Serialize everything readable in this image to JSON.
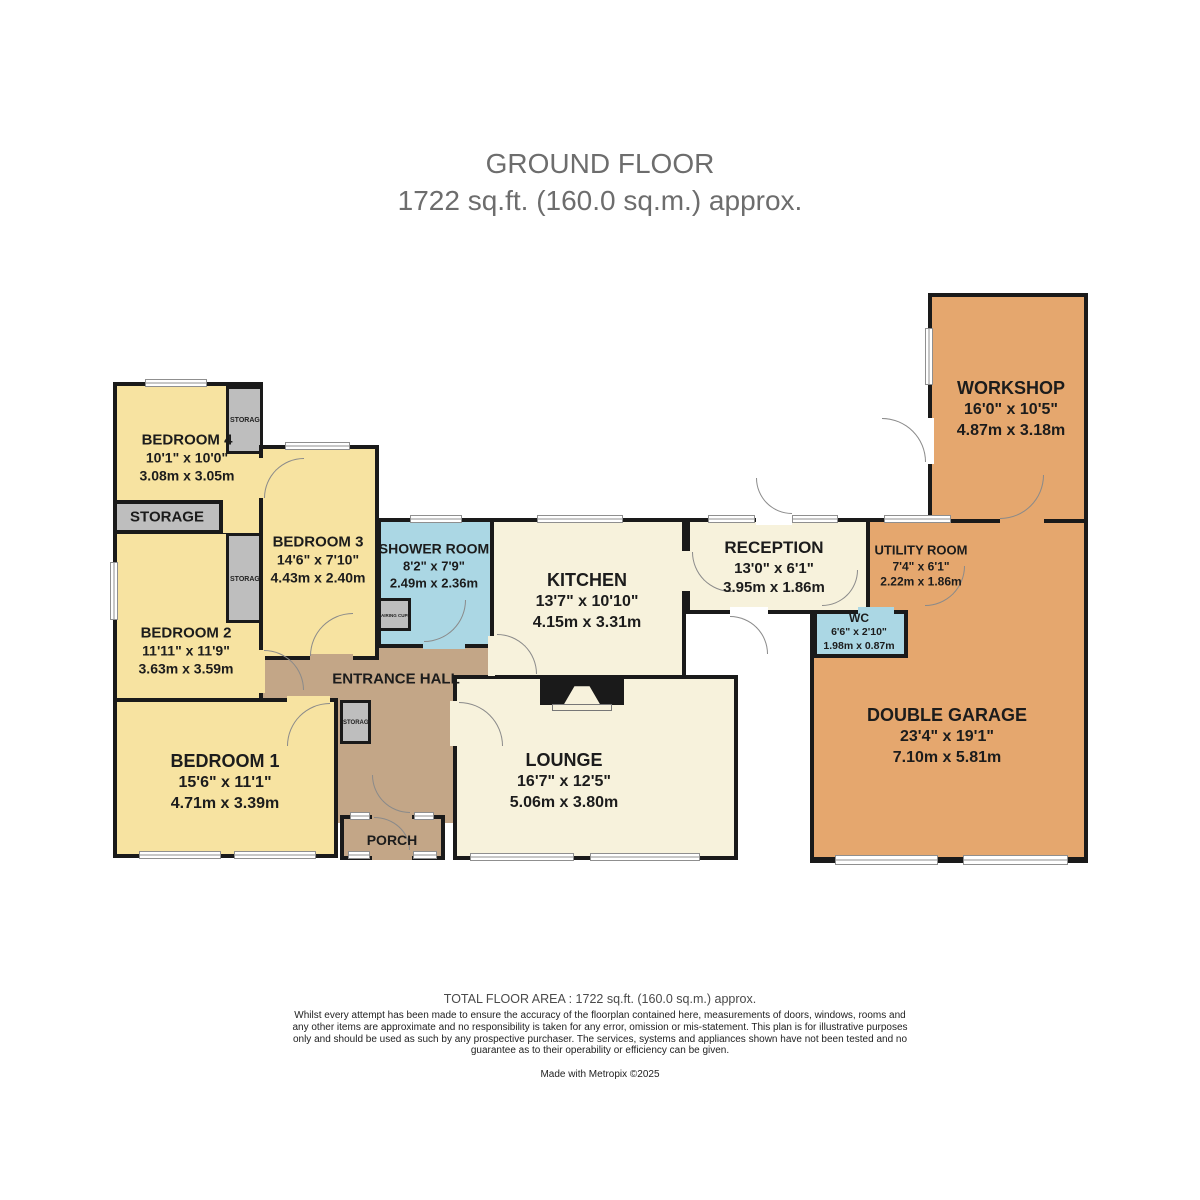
{
  "title": {
    "line1": "GROUND FLOOR",
    "line2": "1722 sq.ft. (160.0 sq.m.) approx."
  },
  "rooms": {
    "bedroom4": {
      "name": "BEDROOM 4",
      "imperial": "10'1\" x 10'0\"",
      "metric": "3.08m x 3.05m"
    },
    "bedroom3": {
      "name": "BEDROOM 3",
      "imperial": "14'6\" x 7'10\"",
      "metric": "4.43m x 2.40m"
    },
    "bedroom2": {
      "name": "BEDROOM 2",
      "imperial": "11'11\" x 11'9\"",
      "metric": "3.63m x 3.59m"
    },
    "bedroom1": {
      "name": "BEDROOM 1",
      "imperial": "15'6\" x 11'1\"",
      "metric": "4.71m x 3.39m"
    },
    "shower_room": {
      "name": "SHOWER ROOM",
      "imperial": "8'2\" x 7'9\"",
      "metric": "2.49m x 2.36m"
    },
    "kitchen": {
      "name": "KITCHEN",
      "imperial": "13'7\" x 10'10\"",
      "metric": "4.15m x 3.31m"
    },
    "lounge": {
      "name": "LOUNGE",
      "imperial": "16'7\" x 12'5\"",
      "metric": "5.06m x 3.80m"
    },
    "reception": {
      "name": "RECEPTION",
      "imperial": "13'0\" x 6'1\"",
      "metric": "3.95m x 1.86m"
    },
    "utility": {
      "name": "UTILITY ROOM",
      "imperial": "7'4\" x 6'1\"",
      "metric": "2.22m x 1.86m"
    },
    "wc": {
      "name": "WC",
      "imperial": "6'6\" x 2'10\"",
      "metric": "1.98m x 0.87m"
    },
    "workshop": {
      "name": "WORKSHOP",
      "imperial": "16'0\" x 10'5\"",
      "metric": "4.87m x 3.18m"
    },
    "garage": {
      "name": "DOUBLE GARAGE",
      "imperial": "23'4\" x 19'1\"",
      "metric": "7.10m x 5.81m"
    },
    "entrance_hall": {
      "name": "ENTRANCE HALL"
    },
    "porch": {
      "name": "PORCH"
    }
  },
  "labels": {
    "storage": "STORAGE",
    "airing_cupboard": "AIRING CUPBOARD"
  },
  "footer": {
    "total": "TOTAL FLOOR AREA : 1722 sq.ft. (160.0 sq.m.) approx.",
    "disclaimer": "Whilst every attempt has been made to ensure the accuracy of the floorplan contained here, measurements of doors, windows, rooms and any other items are approximate and no responsibility is taken for any error, omission or mis-statement. This plan is for illustrative purposes only and should be used as such by any prospective purchaser. The services, systems and appliances shown have not been tested and no guarantee as to their operability or efficiency can be given.",
    "credit": "Made with Metropix ©2025"
  },
  "colors": {
    "bedroom_fill": "#F7E3A1",
    "living_fill": "#F7F2DC",
    "wet_fill": "#ABD7E4",
    "hall_fill": "#C3A687",
    "garage_fill": "#E5A76E",
    "storage_fill": "#BEBEBE",
    "wall": "#1A1A1A"
  }
}
